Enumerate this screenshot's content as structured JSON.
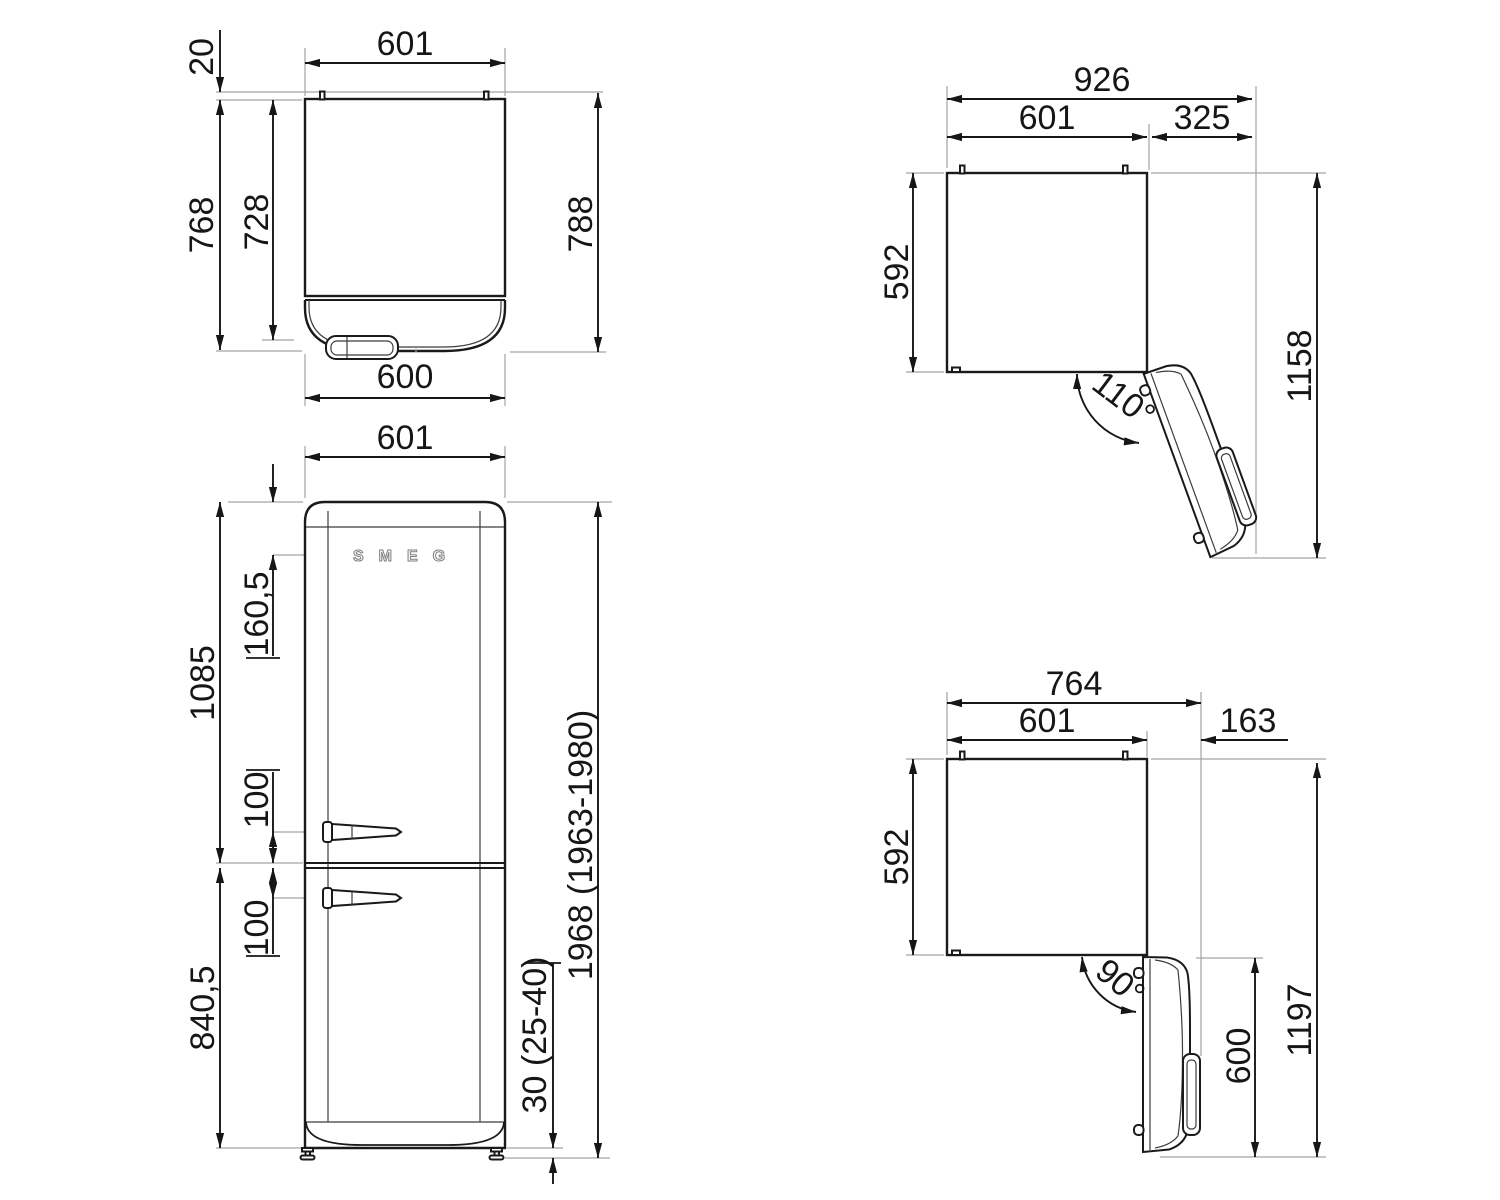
{
  "drawing": {
    "brand_logo": "SMEG",
    "views": {
      "top_view": {
        "dims": {
          "width_top": "601",
          "rear_gap": "20",
          "depth_no_door": "768",
          "body_depth": "728",
          "total_depth": "788",
          "door_width": "600"
        }
      },
      "front_view": {
        "dims": {
          "width": "601",
          "logo_offset": "160,5",
          "upper_section_height": "1085",
          "upper_handle_offset": "100",
          "lower_handle_offset": "100",
          "lower_section_height": "840,5",
          "total_height": "1968 (1963-1980)",
          "feet_height": "30 (25-40)"
        }
      },
      "door_open_110": {
        "dims": {
          "total_width": "926",
          "body_width": "601",
          "door_protrusion": "325",
          "body_depth": "592",
          "total_depth_open": "1158",
          "opening_angle": "110°"
        }
      },
      "door_open_90": {
        "dims": {
          "total_width": "764",
          "body_width": "601",
          "door_protrusion": "163",
          "body_depth": "592",
          "total_depth_open": "1197",
          "door_length": "600",
          "opening_angle": "90°"
        }
      }
    }
  }
}
